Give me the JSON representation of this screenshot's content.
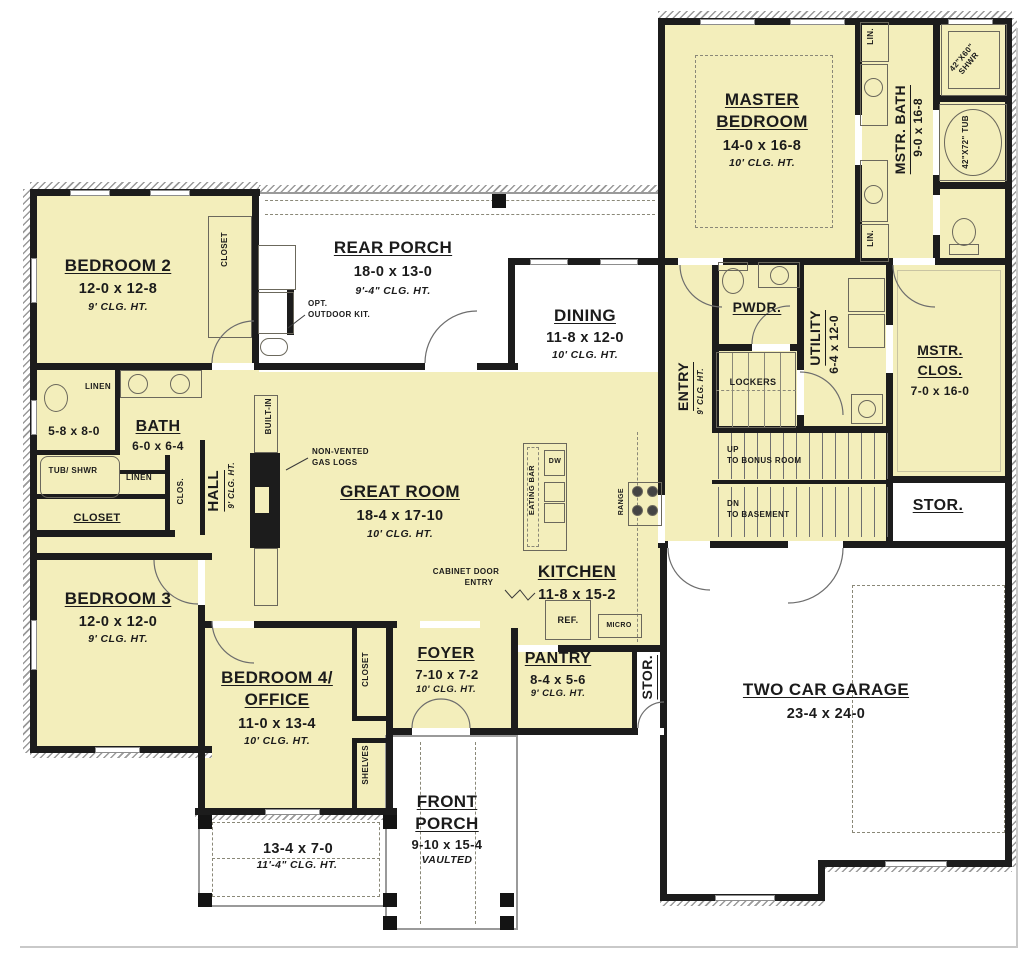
{
  "palette": {
    "wall": "#1c1c1c",
    "room_fill": "#f3eebb",
    "porch_fill": "#ffffff",
    "line": "#6b685c",
    "text": "#1b1b1b"
  },
  "rooms": {
    "master_bedroom": {
      "name1": "MASTER",
      "name2": "BEDROOM",
      "dims": "14-0 x 16-8",
      "clg": "10' CLG. HT."
    },
    "mstr_bath": {
      "name": "MSTR. BATH",
      "dims": "9-0 x 16-8"
    },
    "mstr_clos": {
      "name1": "MSTR.",
      "name2": "CLOS.",
      "dims": "7-0 x 16-0"
    },
    "bedroom2": {
      "name": "BEDROOM 2",
      "dims": "12-0 x 12-8",
      "clg": "9' CLG. HT."
    },
    "bedroom3": {
      "name": "BEDROOM 3",
      "dims": "12-0 x 12-0",
      "clg": "9' CLG. HT."
    },
    "bedroom4": {
      "name1": "BEDROOM 4/",
      "name2": "OFFICE",
      "dims": "11-0 x 13-4",
      "clg": "10' CLG. HT."
    },
    "rear_porch": {
      "name": "REAR PORCH",
      "dims": "18-0 x 13-0",
      "clg": "9'-4\" CLG. HT."
    },
    "front_porch": {
      "name1": "FRONT",
      "name2": "PORCH",
      "dims": "9-10 x 15-4",
      "clg": "VAULTED"
    },
    "left_porch": {
      "dims": "13-4 x 7-0",
      "clg": "11'-4\" CLG. HT."
    },
    "dining": {
      "name": "DINING",
      "dims": "11-8 x 12-0",
      "clg": "10' CLG. HT."
    },
    "great_room": {
      "name": "GREAT ROOM",
      "dims": "18-4 x 17-10",
      "clg": "10' CLG. HT."
    },
    "kitchen": {
      "name": "KITCHEN",
      "dims": "11-8 x 15-2"
    },
    "pantry": {
      "name": "PANTRY",
      "dims": "8-4 x 5-6",
      "clg": "9' CLG. HT."
    },
    "foyer": {
      "name": "FOYER",
      "dims": "7-10 x 7-2",
      "clg": "10' CLG. HT."
    },
    "bath": {
      "name": "BATH",
      "dims": "6-0 x 6-4"
    },
    "bath_wc": {
      "dims": "5-8 x 8-0"
    },
    "hall": {
      "name": "HALL",
      "clg": "9' CLG. HT."
    },
    "entry": {
      "name": "ENTRY",
      "clg": "9' CLG. HT."
    },
    "pwdr": {
      "name": "PWDR."
    },
    "utility": {
      "name": "UTILITY",
      "dims": "6-4 x 12-0"
    },
    "garage": {
      "name": "TWO CAR GARAGE",
      "dims": "23-4 x 24-0"
    },
    "stor_garage": {
      "name": "STOR."
    },
    "stor_pantry": {
      "name": "STOR."
    }
  },
  "labels": {
    "lin": "LIN.",
    "linen": "LINEN",
    "closet": "CLOSET",
    "clos": "CLOS.",
    "lockers": "LOCKERS",
    "shelves": "SHELVES",
    "built_in": "BUILT-IN",
    "tub_shwr": "TUB/ SHWR",
    "shwr_42": "42\"X60\" SHWR",
    "tub_42": "42\"X72\" TUB",
    "eating_bar": "EATING BAR",
    "dw": "DW",
    "range": "RANGE",
    "ref": "REF.",
    "micro": "MICRO"
  },
  "notes": {
    "opt1": "OPT.",
    "opt2": "OUTDOOR KIT.",
    "gas1": "NON-VENTED",
    "gas2": "GAS LOGS",
    "cab1": "CABINET DOOR",
    "cab2": "ENTRY",
    "up": "UP",
    "up_dest": "TO BONUS ROOM",
    "dn": "DN",
    "dn_dest": "TO BASEMENT"
  }
}
